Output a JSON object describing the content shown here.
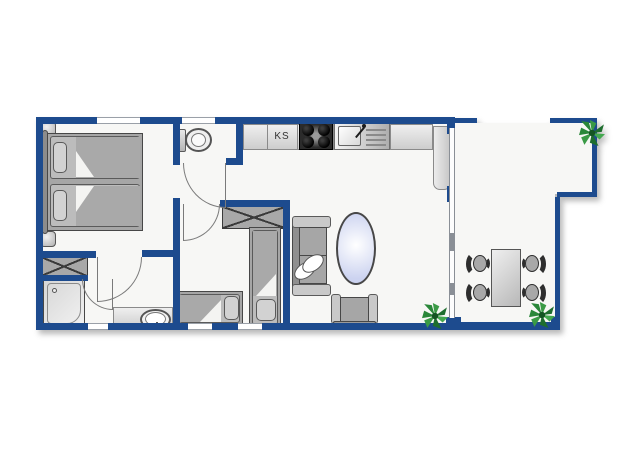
{
  "floorplan": {
    "labels": {
      "fridge": "KS"
    },
    "colors": {
      "wall_blue": "#1d4b8e",
      "floor": "#f7f7f5",
      "furniture_outline": "#474747",
      "furniture_fill": "#a6a6a6",
      "furniture_light": "#c9c9c9",
      "sofa_table_tint": "#ccd3f0",
      "plant_green": "#2e8b3d",
      "stove_dark": "#2b2b2b"
    }
  }
}
